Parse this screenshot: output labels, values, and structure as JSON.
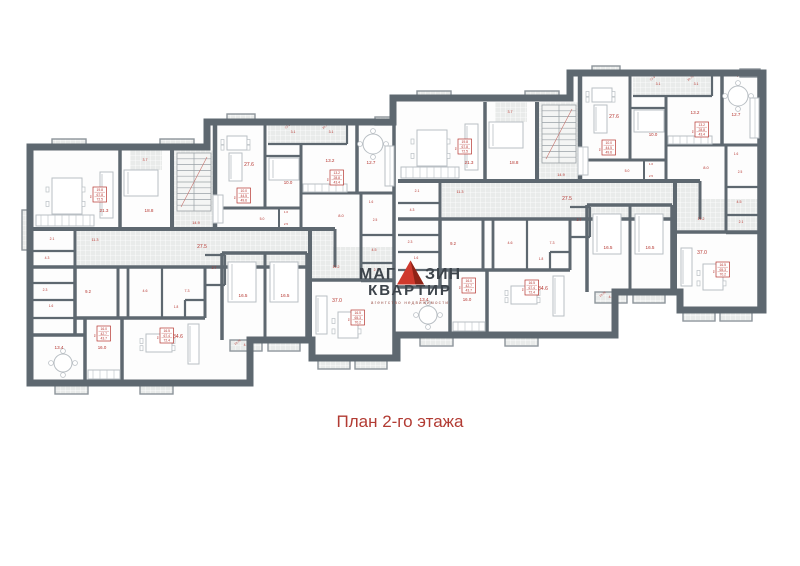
{
  "caption": "План 2-го этажа",
  "watermark": {
    "word1_left": "МАГ",
    "word1_right": "ЗИН",
    "word2": "КВАРТИР",
    "tagline": "агентство недвижимости",
    "triangle_main": "#cf392d",
    "triangle_shade": "#8e2317",
    "text_color": "#3d444b"
  },
  "plan": {
    "colors": {
      "wall": "#5e6870",
      "floor": "#fdfdfd",
      "tile": "#e9ebea",
      "tile_line": "#ffffff",
      "bay_stroke": "#8d959b",
      "label": "#b5342e",
      "furniture": "#b9bfc4",
      "stair_stroke": "#9aa1a6"
    },
    "outline": "30,147 207,147 207,122 393,122 393,98 570,98 570,73 763,73 763,310 680,310 680,292 615,292 615,335 397,335 397,358 312,358 312,340 250,340 250,383 30,383",
    "instances": [
      [
        0,
        0
      ],
      [
        365,
        -48
      ]
    ],
    "block": {
      "tiles": [
        [
          77,
          231,
          256,
          34
        ],
        [
          312,
          247,
          81,
          31
        ],
        [
          174,
          150,
          39,
          77
        ],
        [
          130,
          150,
          32,
          20
        ],
        [
          268,
          125,
          79,
          18
        ]
      ],
      "walls": [
        [
          120,
          150,
          120,
          229,
          3.5
        ],
        [
          172,
          150,
          172,
          229,
          4
        ],
        [
          215,
          123,
          215,
          229,
          4.5
        ],
        [
          33,
          229,
          335,
          229,
          4
        ],
        [
          33,
          267,
          310,
          267,
          3.5
        ],
        [
          75,
          229,
          75,
          267,
          3
        ],
        [
          33,
          251,
          75,
          251,
          2.2
        ],
        [
          75,
          267,
          75,
          335,
          3.5
        ],
        [
          33,
          283,
          75,
          283,
          2.2
        ],
        [
          33,
          300,
          75,
          300,
          2.2
        ],
        [
          33,
          318,
          75,
          318,
          2.2
        ],
        [
          33,
          335,
          85,
          335,
          3.5
        ],
        [
          85,
          318,
          85,
          383,
          3.5
        ],
        [
          118,
          267,
          118,
          318,
          3
        ],
        [
          75,
          318,
          122,
          318,
          3.5
        ],
        [
          122,
          318,
          122,
          383,
          3.5
        ],
        [
          122,
          318,
          205,
          318,
          3.5
        ],
        [
          128,
          267,
          128,
          318,
          2.8
        ],
        [
          162,
          267,
          162,
          318,
          2.2
        ],
        [
          205,
          267,
          205,
          318,
          3
        ],
        [
          185,
          300,
          205,
          300,
          2.2
        ],
        [
          185,
          300,
          185,
          318,
          2.2
        ],
        [
          205,
          255,
          225,
          255,
          2.2
        ],
        [
          225,
          255,
          225,
          285,
          2.2
        ],
        [
          205,
          285,
          225,
          285,
          2.2
        ],
        [
          222,
          253,
          222,
          340,
          3.5
        ],
        [
          222,
          253,
          307,
          253,
          3.5
        ],
        [
          265,
          253,
          265,
          340,
          3
        ],
        [
          307,
          253,
          307,
          340,
          3.5
        ],
        [
          310,
          229,
          310,
          358,
          4
        ],
        [
          310,
          280,
          395,
          280,
          3.5
        ],
        [
          335,
          229,
          335,
          267,
          3
        ],
        [
          265,
          123,
          265,
          208,
          3
        ],
        [
          347,
          123,
          347,
          144,
          2.2
        ],
        [
          268,
          144,
          347,
          144,
          2.2
        ],
        [
          265,
          156,
          301,
          156,
          2.2
        ],
        [
          301,
          144,
          301,
          229,
          3
        ],
        [
          357,
          121,
          357,
          193,
          3.5
        ],
        [
          301,
          193,
          357,
          193,
          3
        ],
        [
          357,
          193,
          395,
          193,
          3
        ],
        [
          215,
          208,
          301,
          208,
          3
        ],
        [
          279,
          208,
          279,
          229,
          2
        ],
        [
          361,
          193,
          361,
          281,
          3
        ],
        [
          361,
          235,
          395,
          235,
          2.2
        ],
        [
          361,
          263,
          395,
          263,
          2.2
        ],
        [
          361,
          281,
          395,
          281,
          2.5
        ],
        [
          394,
          121,
          394,
          358,
          3.5
        ]
      ],
      "stairs": [
        [
          177,
          153,
          34,
          58
        ]
      ],
      "bays": [
        [
          52,
          139,
          34,
          9
        ],
        [
          160,
          139,
          34,
          9
        ],
        [
          227,
          114,
          28,
          8
        ],
        [
          375,
          117,
          20,
          8
        ],
        [
          55,
          383,
          33,
          11
        ],
        [
          140,
          383,
          33,
          11
        ],
        [
          230,
          340,
          32,
          11
        ],
        [
          268,
          340,
          32,
          11
        ],
        [
          318,
          358,
          32,
          11
        ],
        [
          355,
          358,
          32,
          11
        ]
      ],
      "labels": [
        [
          104,
          212,
          "21.3",
          4.6
        ],
        [
          149,
          212,
          "18.8",
          4.6
        ],
        [
          145,
          161,
          "3.7",
          3.6
        ],
        [
          196,
          224,
          "14.9",
          3.8
        ],
        [
          202,
          248,
          "27.5",
          5
        ],
        [
          95,
          241,
          "11.3",
          3.8
        ],
        [
          52,
          240,
          "2.1",
          3.4
        ],
        [
          47,
          259,
          "4.3",
          3.4
        ],
        [
          45,
          291,
          "2.3",
          3.4
        ],
        [
          51,
          307,
          "1.6",
          3.2
        ],
        [
          88,
          293,
          "9.2",
          4.2
        ],
        [
          59,
          349,
          "13.4",
          4.6
        ],
        [
          102,
          349,
          "16.0",
          4.4
        ],
        [
          145,
          292,
          "4.6",
          3.6
        ],
        [
          187,
          292,
          "7.3",
          3.6
        ],
        [
          176,
          308,
          "1.8",
          3.2
        ],
        [
          178,
          338,
          "34.6",
          5
        ],
        [
          214,
          269,
          "2.7",
          3.4
        ],
        [
          243,
          297,
          "16.5",
          4.6
        ],
        [
          285,
          297,
          "16.5",
          4.6
        ],
        [
          246,
          346,
          "4.0",
          3.4
        ],
        [
          284,
          346,
          "3.9",
          3.4
        ],
        [
          337,
          302,
          "37.0",
          5
        ],
        [
          336,
          268,
          "11.2",
          3.8
        ],
        [
          249,
          166,
          "27.6",
          5
        ],
        [
          288,
          184,
          "10.0",
          4.4
        ],
        [
          262,
          220,
          "5.0",
          3.4
        ],
        [
          286,
          213,
          "1.6",
          3.0
        ],
        [
          286,
          225,
          "2.5",
          3.0
        ],
        [
          330,
          162,
          "13.2",
          4.6
        ],
        [
          371,
          164,
          "12.7",
          4.6
        ],
        [
          341,
          217,
          "8.0",
          4.0
        ],
        [
          371,
          203,
          "1.6",
          3.2
        ],
        [
          375,
          221,
          "2.5",
          3.2
        ],
        [
          374,
          251,
          "4.5",
          3.6
        ],
        [
          376,
          271,
          "2.1",
          3.4
        ],
        [
          293,
          133,
          "3.1",
          3.4
        ],
        [
          331,
          133,
          "3.1",
          3.4
        ]
      ],
      "apt_boxes": [
        [
          93,
          187,
          [
            "19.8",
            "67.8",
            "72.5"
          ]
        ],
        [
          97,
          326,
          [
            "16.0",
            "42.7",
            "43.7"
          ]
        ],
        [
          160,
          328,
          [
            "16.5",
            "67.4",
            "72.4"
          ]
        ],
        [
          330,
          170,
          [
            "13.2",
            "28.8",
            "43.4"
          ]
        ],
        [
          237,
          188,
          [
            "10.0",
            "44.5",
            "49.6"
          ]
        ],
        [
          351,
          310,
          [
            "16.5",
            "65.3",
            "70.2"
          ]
        ]
      ],
      "diag_labels": [
        [
          66,
          144,
          "26-8"
        ],
        [
          174,
          144,
          "26-8"
        ],
        [
          240,
          119,
          "17-20"
        ],
        [
          288,
          127,
          "22-9"
        ],
        [
          326,
          127,
          "20-75"
        ],
        [
          375,
          123,
          "24-15"
        ],
        [
          183,
          143,
          "21-90"
        ],
        [
          71,
          389,
          "0.5"
        ],
        [
          156,
          389,
          "0.5"
        ],
        [
          334,
          364,
          "0.5"
        ],
        [
          371,
          364,
          "0.5"
        ],
        [
          238,
          343,
          "23-75"
        ],
        [
          276,
          343,
          "20-9"
        ]
      ],
      "kv_mark": "кв",
      "furniture": [
        [
          "table",
          52,
          178,
          30,
          36
        ],
        [
          "sofa",
          100,
          172,
          13,
          46
        ],
        [
          "counter",
          36,
          215,
          58,
          11
        ],
        [
          "bed",
          124,
          170,
          34,
          26
        ],
        [
          "round",
          63,
          363,
          9
        ],
        [
          "counter",
          88,
          370,
          32,
          9
        ],
        [
          "table",
          146,
          334,
          26,
          18
        ],
        [
          "sofa",
          188,
          324,
          11,
          40
        ],
        [
          "bed",
          228,
          262,
          28,
          40
        ],
        [
          "bed",
          270,
          262,
          28,
          40
        ],
        [
          "table",
          338,
          312,
          20,
          26
        ],
        [
          "sofa",
          316,
          296,
          11,
          38
        ],
        [
          "table",
          227,
          136,
          20,
          14
        ],
        [
          "sofa",
          229,
          153,
          13,
          28
        ],
        [
          "counter",
          213,
          195,
          10,
          28
        ],
        [
          "bed",
          269,
          158,
          30,
          22
        ],
        [
          "round",
          373,
          144,
          10
        ],
        [
          "counter",
          303,
          184,
          44,
          8
        ],
        [
          "counter",
          385,
          146,
          9,
          40
        ]
      ]
    },
    "extras": {
      "bays": [
        [
          22,
          210,
          8,
          40
        ]
      ]
    }
  }
}
